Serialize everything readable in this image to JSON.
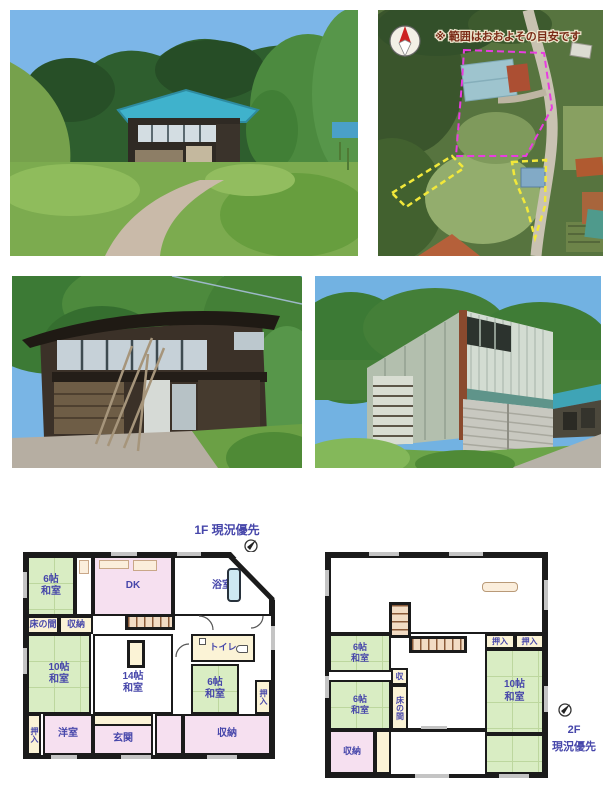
{
  "document": {
    "kind": "real-estate flyer",
    "background": "#ffffff"
  },
  "colors": {
    "wall": "#1b1b1b",
    "tatami_green": "#d9edc3",
    "room_pink": "#f6e0f0",
    "closet_cream": "#fbf3d6",
    "label_blue": "#4646aa",
    "boundary_magenta": "#e83ce0",
    "boundary_yellow": "#f2e83a",
    "map_note_red": "#7a2a16",
    "bathtub_blue": "#cde8f2"
  },
  "photos": {
    "photo1_alt": "house exterior with blue roof and path",
    "photo2_alt": "dark wooden two-story house",
    "photo3_alt": "metal-sided warehouse building"
  },
  "map": {
    "note": "※ 範囲はおおよその目安です"
  },
  "floor1": {
    "title": "1F 現況優先",
    "rooms": {
      "washitsu6_nw": "6帖\n和室",
      "dk": "DK",
      "bath": "浴室",
      "tokonoma": "床の間",
      "storage_strip": "収納",
      "washitsu10": "10帖\n和室",
      "washitsu14": "14帖\n和室",
      "toilet": "トイレ",
      "washitsu6_e": "6帖\n和室",
      "oshiire_e": "押入",
      "oshiire_w": "押入",
      "western_room": "洋室",
      "entrance": "玄関",
      "storage_big": "収納"
    }
  },
  "floor2": {
    "title": "2F\n現況優先",
    "rooms": {
      "washitsu6_n": "6帖\n和室",
      "washitsu6_s": "6帖\n和室",
      "oshiire_a": "押入",
      "oshiire_b": "押入",
      "washitsu10": "10帖\n和室",
      "storage_small": "収",
      "tokonoma": "床の間",
      "storage": "収納"
    }
  }
}
